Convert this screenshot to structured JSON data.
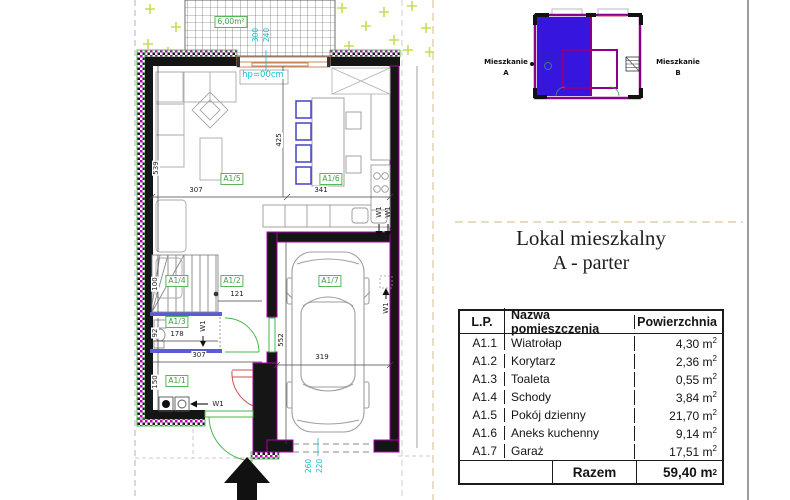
{
  "title": {
    "line1": "Lokal mieszkalny",
    "line2": "A - parter"
  },
  "mini_plan": {
    "label": "Mieszkanie",
    "unit_a": "A",
    "unit_b": "B"
  },
  "plan": {
    "terrace_area": "6,00m²",
    "hp_label": "hp=00cm",
    "vent_label": "W1",
    "cyan_dims": {
      "terrace_door_w": "300",
      "terrace_door_h": "240",
      "garage_door_w": "260",
      "garage_door_h": "220"
    },
    "room_tags": {
      "a1_1": "A1/1",
      "a1_2": "A1/2",
      "a1_3": "A1/3",
      "a1_4": "A1/4",
      "a1_5": "A1/5",
      "a1_6": "A1/6",
      "a1_7": "A1/7"
    },
    "dims": {
      "living_h": "539",
      "living_w": "307",
      "kitchen_h": "425",
      "kitchen_w": "341",
      "stairs_h": "100",
      "corridor_w": "121",
      "toilet_h": "92",
      "toilet_w": "178",
      "hall_w": "307",
      "vestibule_h": "150",
      "garage_h": "552",
      "garage_w": "319"
    }
  },
  "table": {
    "headers": {
      "lp": "L.P.",
      "name": "Nazwa pomieszczenia",
      "area": "Powierzchnia"
    },
    "unit": "m",
    "unit_sup": "2",
    "rows": [
      {
        "id": "A1.1",
        "name": "Wiatrołap",
        "area": "4,30"
      },
      {
        "id": "A1.2",
        "name": "Korytarz",
        "area": "2,36"
      },
      {
        "id": "A1.3",
        "name": "Toaleta",
        "area": "0,55"
      },
      {
        "id": "A1.4",
        "name": "Schody",
        "area": "3,84"
      },
      {
        "id": "A1.5",
        "name": "Pokój dzienny",
        "area": "21,70"
      },
      {
        "id": "A1.6",
        "name": "Aneks kuchenny",
        "area": "9,14"
      },
      {
        "id": "A1.7",
        "name": "Garaż",
        "area": "17,51"
      }
    ],
    "total_label": "Razem",
    "total_value": "59,40"
  },
  "colors": {
    "wall": "#151515",
    "insulation_magenta": "#bb00bb",
    "accent_magenta": "#aa00aa",
    "door_green": "#4ab54a",
    "door_red": "#cf4f4f",
    "dim_cyan": "#15bfc9",
    "tag_green": "#57b857",
    "apartment_a_fill": "#3615df",
    "boundary_tan": "#d9c79b",
    "grass_green": "#c9dc55",
    "furniture_grey": "#a8a8a8",
    "lintel_blue": "#5b5bd6"
  }
}
